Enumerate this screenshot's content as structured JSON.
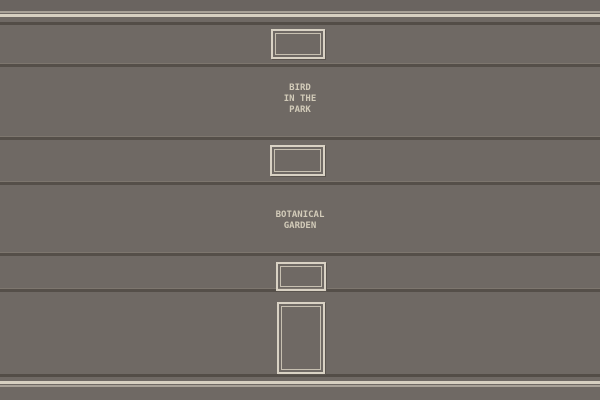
{
  "colors": {
    "wall": "#6f6964",
    "wall_top": "#6a6460",
    "trim_cream": "#d7d0c1",
    "trim_light": "#a9a298",
    "trim_dark": "#534d47",
    "divider_dark": "#554f49",
    "divider_light": "#7d766e",
    "frame_outer": "#d9d2c4",
    "frame_inner": "#c7c0b1",
    "frame_shadow": "#5a544e",
    "label_text": "#d2cbb9"
  },
  "labels": [
    {
      "name": "bird-in-the-park",
      "lines": [
        "BIRD",
        "IN THE",
        "PARK"
      ]
    },
    {
      "name": "botanical-garden",
      "lines": [
        "BOTANICAL",
        "GARDEN"
      ]
    }
  ],
  "frames": [
    {
      "name": "frame-top",
      "shape": "landscape",
      "content": "empty"
    },
    {
      "name": "frame-middle",
      "shape": "landscape",
      "content": "empty"
    },
    {
      "name": "frame-lower",
      "shape": "landscape",
      "content": "empty"
    },
    {
      "name": "frame-bottom",
      "shape": "portrait",
      "content": "empty"
    }
  ]
}
